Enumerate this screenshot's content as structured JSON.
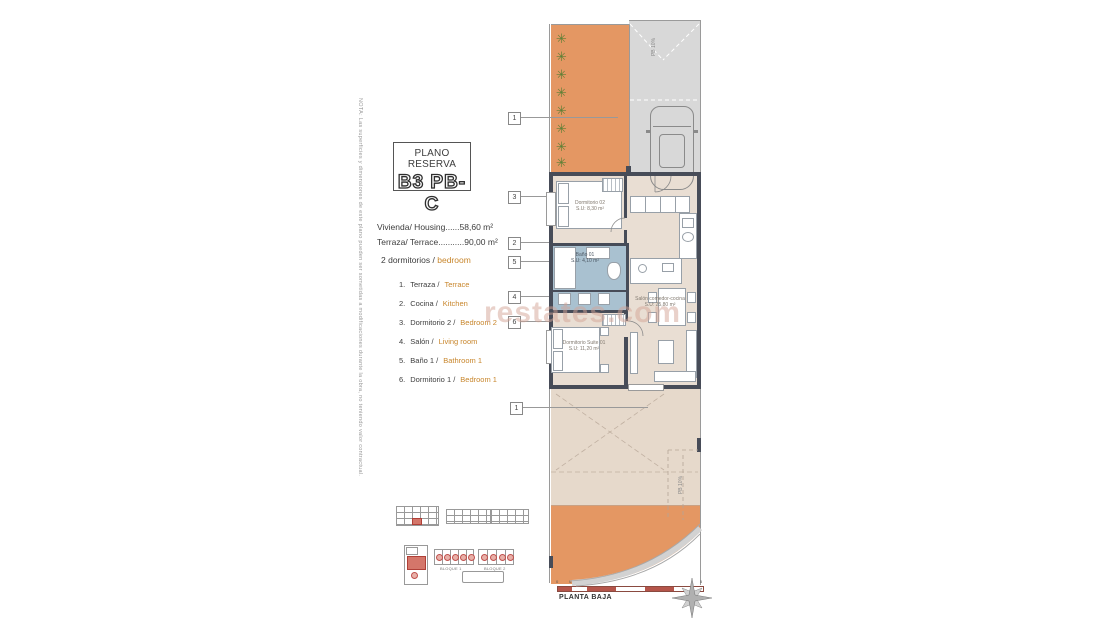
{
  "note": "NOTA: Las superficies y dimensiones de este plano pueden ser sometidas a modificaciones durante la obra, no teniendo valor contractual.",
  "title": {
    "line1": "PLANO RESERVA",
    "line2": "B3 PB-C"
  },
  "areas": {
    "housing": "Vivienda/ Housing......58,60 m²",
    "terrace": "Terraza/ Terrace...........90,00 m²"
  },
  "bedrooms": {
    "prefix": "2 dormitorios /",
    "highlight": "bedroom"
  },
  "legend": [
    {
      "num": "1.",
      "es": "Terraza /",
      "en": "Terrace"
    },
    {
      "num": "2.",
      "es": "Cocina /",
      "en": "Kitchen"
    },
    {
      "num": "3.",
      "es": "Dormitorio 2 /",
      "en": "Bedroom 2"
    },
    {
      "num": "4.",
      "es": "Salón /",
      "en": "Living room"
    },
    {
      "num": "5.",
      "es": "Baño 1 /",
      "en": "Bathroom 1"
    },
    {
      "num": "6.",
      "es": "Dormitorio 1 /",
      "en": "Bedroom 1"
    }
  ],
  "plan": {
    "callouts": [
      "1",
      "3",
      "2",
      "5",
      "4",
      "6",
      "1"
    ],
    "rooms": {
      "bedroom2": {
        "name": "Dormitorio 02",
        "area": "S.U: 8,30 m²"
      },
      "bath": {
        "name": "Baño 01",
        "area": "S.U: 4,10 m²"
      },
      "living": {
        "name": "Salón comedor-cocina",
        "area": "S.U: 25,80 m²"
      },
      "suite": {
        "name": "Dormitorio Suite 01",
        "area": "S.U: 11,20 m²"
      }
    },
    "ramp_top": "PB 10%",
    "ramp_bottom": "PB 10%"
  },
  "keyplan": {
    "block1": "BLOQUE 1",
    "block2": "BLOQUE 2"
  },
  "footer": {
    "plan_name": "PLANTA BAJA",
    "scale_ticks": [
      "0",
      "0.5",
      "1",
      "2",
      "3",
      "4",
      "5"
    ]
  },
  "watermark": "restates.com",
  "icons": {
    "plant": "✳"
  },
  "colors": {
    "terrace_orange": "#e49763",
    "driveway_gray": "#d8d8d8",
    "floor_beige": "#e9ded3",
    "terrace_beige": "#e6d9cb",
    "bath_blue": "#a9c1d0",
    "wall": "#474c58",
    "accent_orange": "#c8862c",
    "keyplan_red": "#c0504d"
  }
}
